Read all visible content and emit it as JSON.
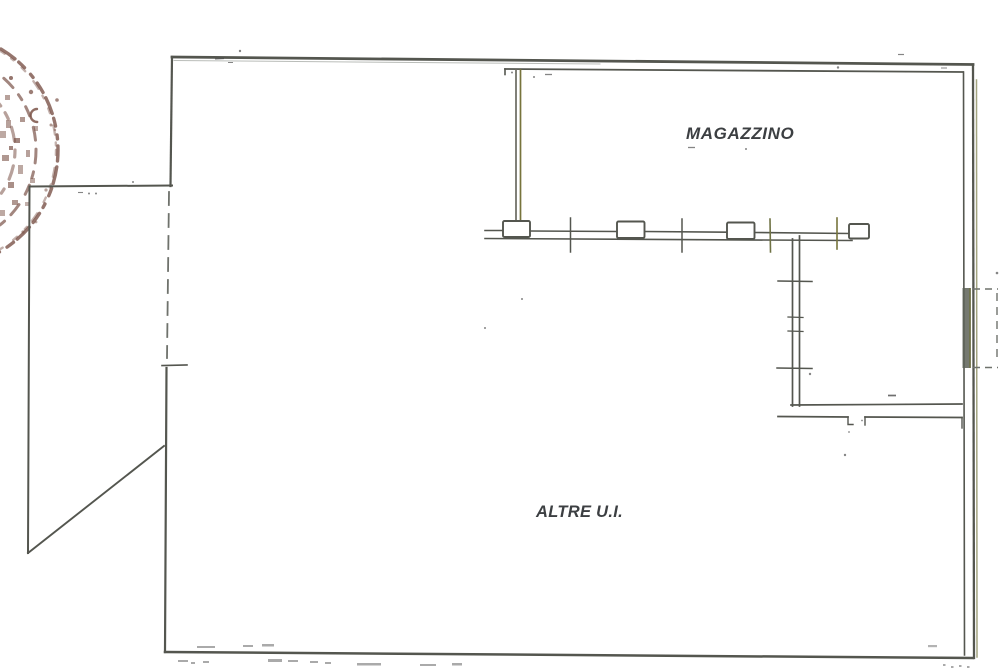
{
  "plan": {
    "rooms": [
      {
        "id": "magazzino",
        "label": "MAGAZZINO"
      },
      {
        "id": "altre-ui",
        "label": "ALTRE U.I."
      }
    ],
    "stamp": {
      "name": "notary-seal-stamp",
      "color": "#7b5348"
    },
    "colors": {
      "wall": "#54564f",
      "wall_light": "#6f726c",
      "olive_accent": "#77743c",
      "label_text": "#3c3f42",
      "stamp": "#7b5348",
      "background": "#ffffff"
    }
  }
}
